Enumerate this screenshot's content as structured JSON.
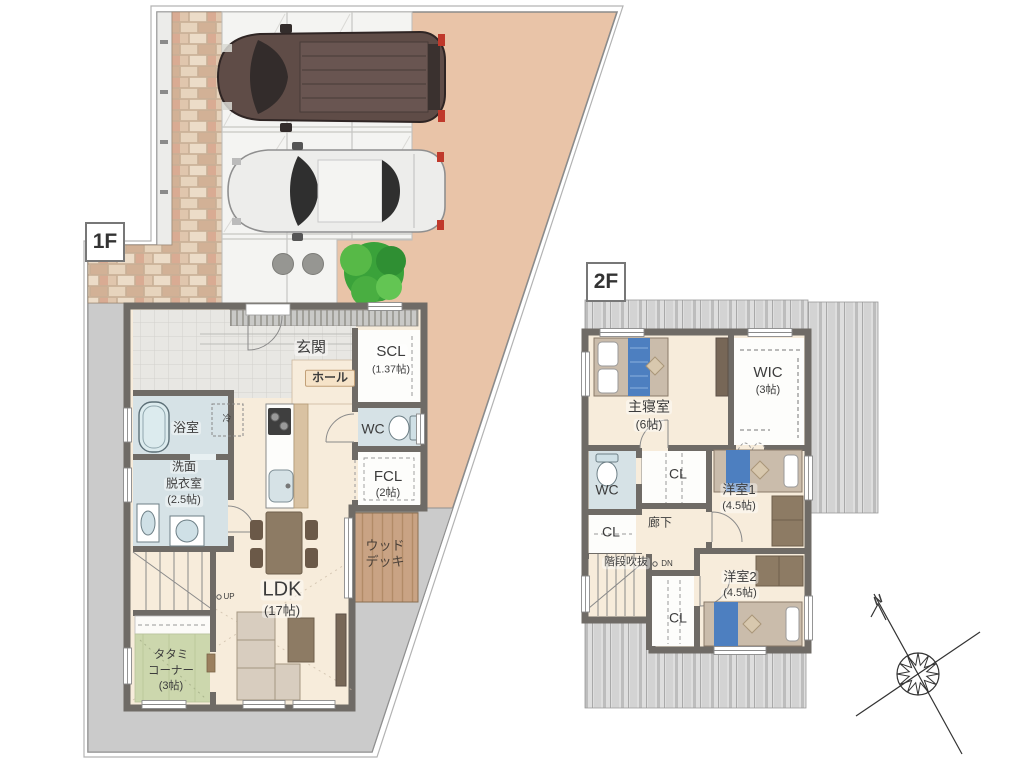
{
  "f1": {
    "tag": "1F",
    "genkan": "玄関",
    "scl": "SCL",
    "scl_size": "(1.37帖)",
    "hall": "ホール",
    "wc": "WC",
    "fcl": "FCL",
    "fcl_size": "(2帖)",
    "bath": "浴室",
    "senmen_l1": "洗面",
    "senmen_l2": "脱衣室",
    "senmen_size": "(2.5帖)",
    "ldk": "LDK",
    "ldk_size": "(17帖)",
    "tatami_l1": "タタミ",
    "tatami_l2": "コーナー",
    "tatami_size": "(3帖)",
    "deck_l1": "ウッド",
    "deck_l2": "デッキ",
    "up": "UP",
    "fridge": "冷"
  },
  "f2": {
    "tag": "2F",
    "master": "主寝室",
    "master_size": "(6帖)",
    "wic": "WIC",
    "wic_size": "(3帖)",
    "wc": "WC",
    "cl_top": "CL",
    "cl_left": "CL",
    "cl_bottom": "CL",
    "hallway": "廊下",
    "stairwell": "階段吹抜",
    "dn": "DN",
    "west1": "洋室1",
    "west1_size": "(4.5帖)",
    "west2": "洋室2",
    "west2_size": "(4.5帖)"
  },
  "compass": {
    "north": "N"
  },
  "colors": {
    "site_ground": "#e9c4a8",
    "paving": "#f4f4f2",
    "concrete": "#cbcbcb",
    "wall": "#6f6b66",
    "floor": "#f7ecdb",
    "wet_room": "#d6e2e6",
    "tatami": "#ccd7ad",
    "wood_deck": "#c9a384",
    "roof_hatch": "#dedede",
    "tree": "#3aa23a",
    "bed_accent": "#4d7fc0"
  }
}
